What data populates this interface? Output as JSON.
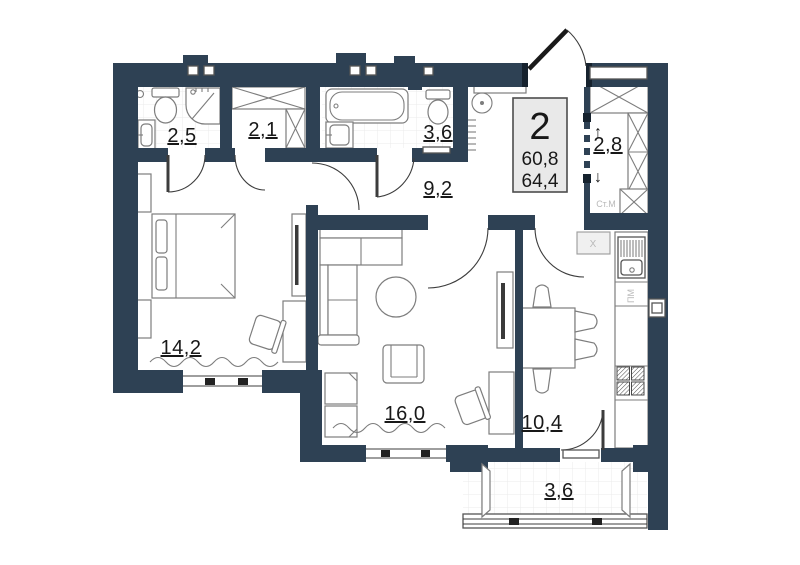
{
  "plan": {
    "unit_badge": {
      "rooms": "2",
      "area_living": "60,8",
      "area_total": "64,4"
    },
    "rooms": [
      {
        "id": "bathroom-ensuite",
        "area": "2,5"
      },
      {
        "id": "closet",
        "area": "2,1"
      },
      {
        "id": "bathroom",
        "area": "3,6"
      },
      {
        "id": "hallway",
        "area": "9,2"
      },
      {
        "id": "wardrobe",
        "area": "2,8"
      },
      {
        "id": "bedroom",
        "area": "14,2"
      },
      {
        "id": "living-room",
        "area": "16,0"
      },
      {
        "id": "kitchen",
        "area": "10,4"
      },
      {
        "id": "balcony",
        "area": "3,6"
      }
    ],
    "annotations": {
      "washing_machine": "Ст.М",
      "dishwasher": "ПМ",
      "fridge": "X",
      "arrow_up": "↑",
      "arrow_down": "↓"
    },
    "colors": {
      "wall": "#2e4154",
      "floor": "#ffffff",
      "tile_line": "#e9e9e9",
      "furniture": "#7d7d7d",
      "badge_bg": "#e9e9e9",
      "text": "#181818",
      "muted_text": "#b9b9b9"
    }
  }
}
